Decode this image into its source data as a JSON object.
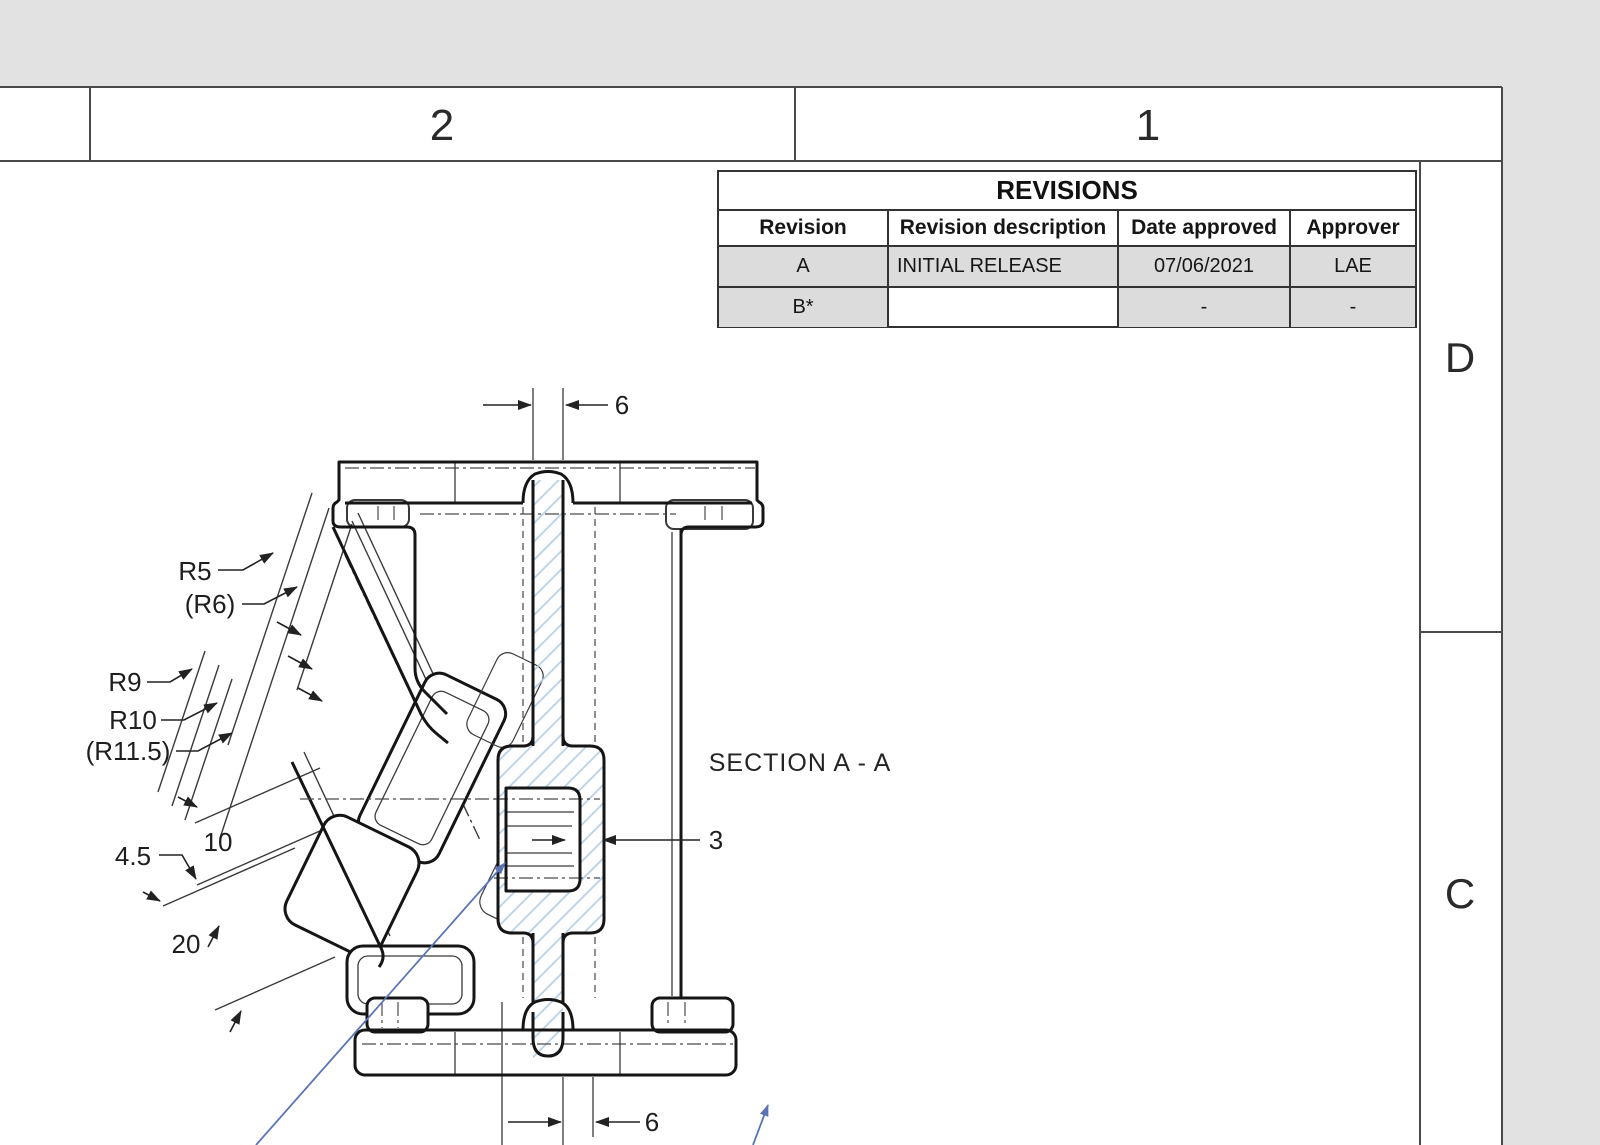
{
  "frame": {
    "zone_columns_top": [
      {
        "label": "2"
      },
      {
        "label": "1"
      }
    ],
    "zone_rows_right": [
      {
        "label": "D"
      },
      {
        "label": "C"
      }
    ]
  },
  "revisions_table": {
    "title": "REVISIONS",
    "headers": [
      "Revision",
      "Revision description",
      "Date approved",
      "Approver"
    ],
    "rows": [
      [
        "A",
        "INITIAL RELEASE",
        "07/06/2021",
        "LAE"
      ],
      [
        "B*",
        "",
        "-",
        "-"
      ]
    ]
  },
  "section": {
    "label": "SECTION A - A"
  },
  "dimensions": {
    "top_web_width": "6",
    "bottom_web_width": "6",
    "wall_thickness": "3",
    "depth_ten": "10",
    "depth_four_five": "4.5",
    "depth_twenty": "20"
  },
  "radii": {
    "r5": "R5",
    "r6": "(R6)",
    "r9": "R9",
    "r10": "R10",
    "r11_5": "(R11.5)"
  },
  "colors": {
    "outside_bg": "#e2e2e2",
    "sheet_bg": "#ffffff",
    "frame_line": "#4a4a4a",
    "drawing_line": "#1f1f1f",
    "hatch_blue": "#b5cfe6",
    "leader_blue": "#5b74b8",
    "row_shade": "#dcdcdc"
  }
}
